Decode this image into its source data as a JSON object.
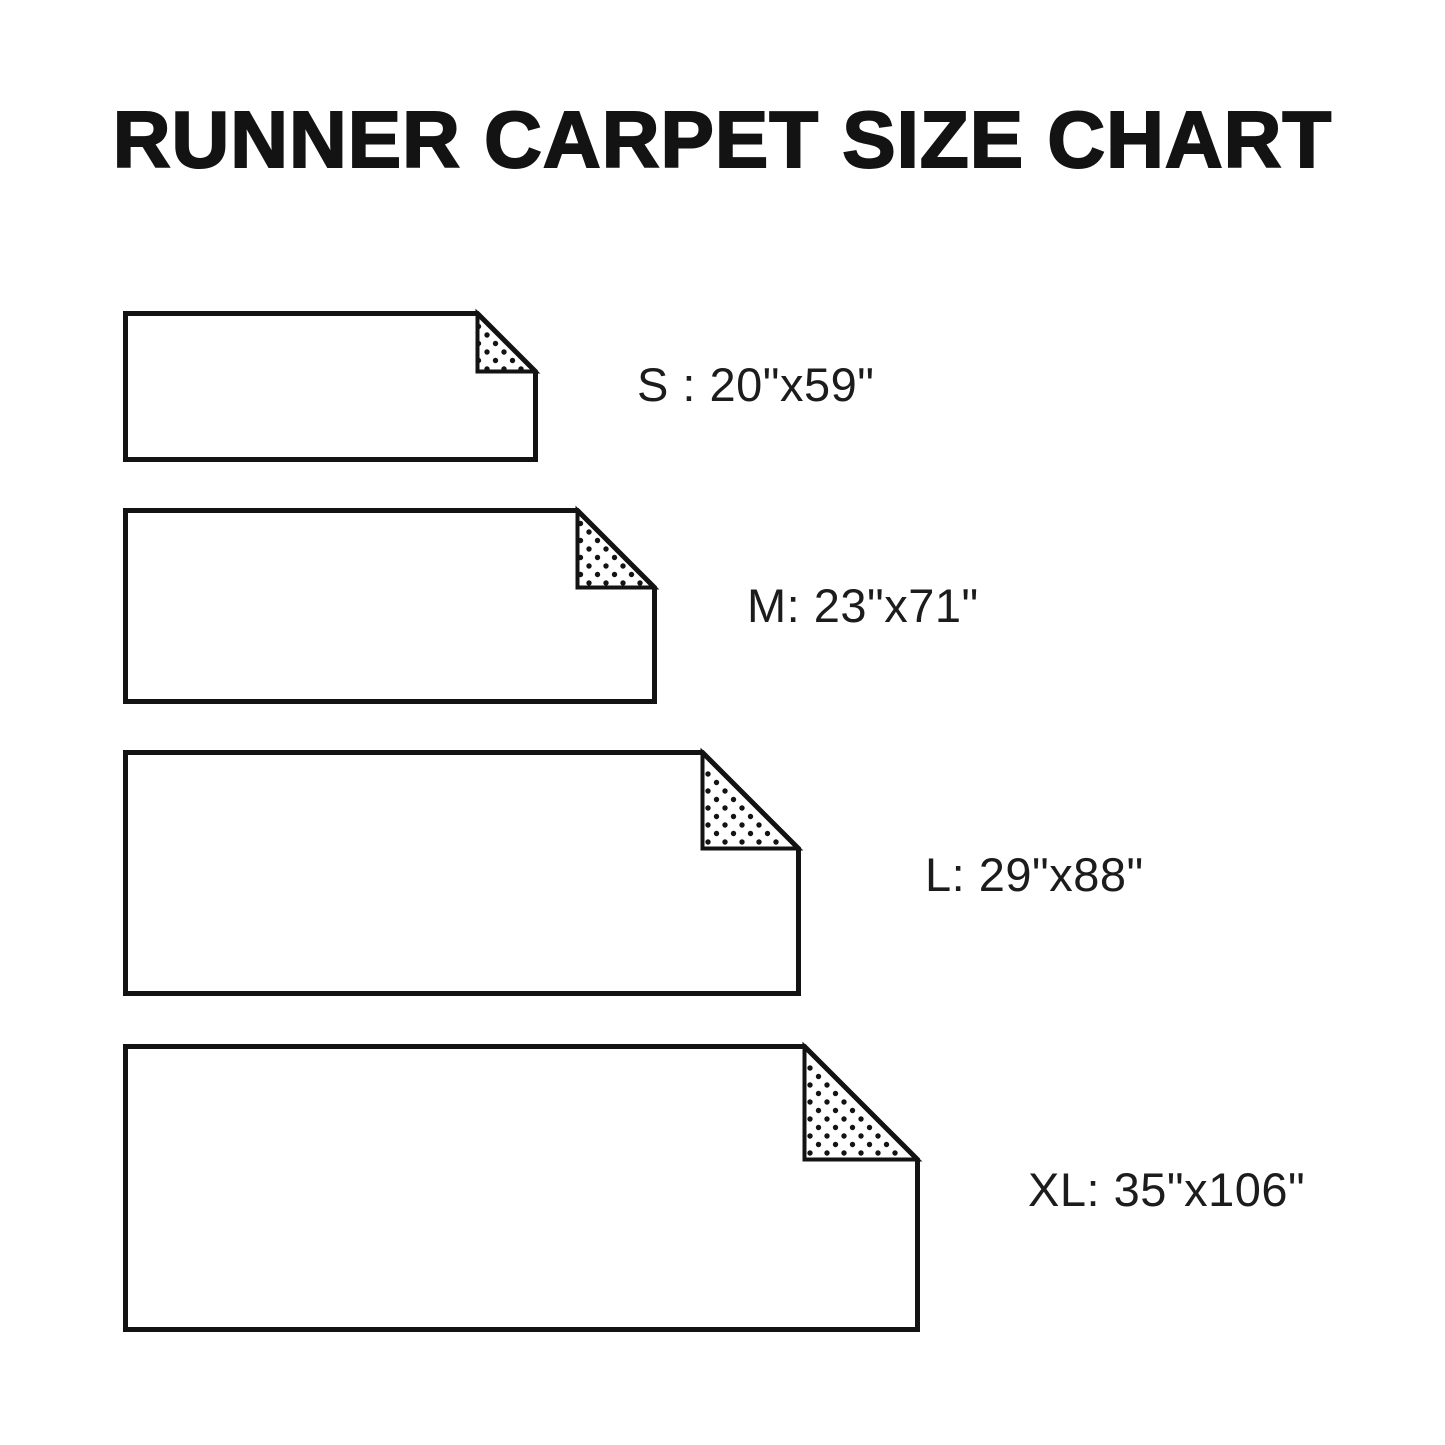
{
  "title": "RUNNER CARPET SIZE CHART",
  "colors": {
    "background": "#ffffff",
    "line": "#131313",
    "text": "#1c1c1c",
    "dots": "#131313"
  },
  "chart_data": {
    "type": "table",
    "title": "RUNNER CARPET SIZE CHART",
    "categories": [
      "S",
      "M",
      "L",
      "XL"
    ],
    "dimensions_inches": [
      "20\"x59\"",
      "23\"x71\"",
      "29\"x88\"",
      "35\"x106\""
    ]
  },
  "sizes": [
    {
      "code": "S",
      "label": "S : 20\"x59\"",
      "width_in": 20,
      "length_in": 59
    },
    {
      "code": "M",
      "label": "M: 23\"x71\"",
      "width_in": 23,
      "length_in": 71
    },
    {
      "code": "L",
      "label": "L: 29\"x88\"",
      "width_in": 29,
      "length_in": 88
    },
    {
      "code": "XL",
      "label": "XL: 35\"x106\"",
      "width_in": 35,
      "length_in": 106
    }
  ]
}
